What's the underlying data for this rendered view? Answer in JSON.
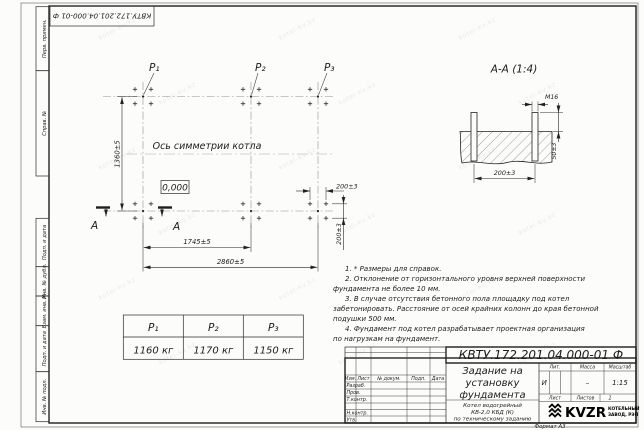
{
  "watermark": {
    "text": "kotel-kv.kz"
  },
  "stamp_top": {
    "doc_number": "КВТУ.172.201.04.000-01 Ф"
  },
  "margin_labels": {
    "perv": "Перв. примен.",
    "sprav": "Справ. №",
    "podp1": "Подп. и дата",
    "inv_dubl": "Инв. № дубл.",
    "vzam": "Взам. инв. №",
    "podp2": "Подп. и дата",
    "inv_podl": "Инв. № подл."
  },
  "plan": {
    "p1": "P₁",
    "p2": "P₂",
    "p3": "P₃",
    "axis_label": "Ось симметрии котла",
    "level": "0,000",
    "dim_v": "1360±5",
    "dim_1745": "1745±5",
    "dim_2860": "2860±5",
    "dim_200h": "200±3",
    "dim_200v": "200±3",
    "section_letter_left": "А",
    "section_letter_right": "А"
  },
  "section": {
    "title": "А-А (1:4)",
    "thread": "М16",
    "dim_50": "50±3",
    "dim_200": "200±3"
  },
  "notes": {
    "lines": [
      "1. * Размеры для справок.",
      "2. Отклонение от горизонтального уровня верхней поверхности",
      "фундамента не более 10 мм.",
      "3. В случае отсутствия бетонного пола площадку под котел",
      "забетонировать. Расстояние от осей крайних колонн до края бетонной",
      "подушки 500 мм.",
      "4. Фундамент под котел разрабатывает проектная организация",
      "по нагрузкам на фундамент."
    ]
  },
  "load_table": {
    "headers": [
      "P₁",
      "P₂",
      "P₃"
    ],
    "values": [
      "1160 кг",
      "1170 кг",
      "1150 кг"
    ]
  },
  "title_block": {
    "doc_number": "КВТУ.172.201.04.000-01 Ф",
    "title_lines": [
      "Задание на",
      "установку",
      "фундамента"
    ],
    "subtitle_lines": [
      "Котел водогрейный",
      "КВ-2,0 КБД (К)",
      "по техническому заданию"
    ],
    "cols": {
      "izm": "Изм.",
      "list": "Лист",
      "doc": "№ докум.",
      "podp": "Подп.",
      "data": "Дата"
    },
    "rows": {
      "razrab": "Разраб.",
      "prov": "Пров.",
      "tkontr": "Т.контр.",
      "nkontr": "Н.контр.",
      "utv": "Утв."
    },
    "lit_label": "Лит.",
    "massa_label": "Масса",
    "masshtab_label": "Масштаб",
    "lit_value": "И",
    "massa_value": "–",
    "masshtab_value": "1:15",
    "list_label": "Лист",
    "listov_label": "Листов",
    "listov_value": "1",
    "logo_text": "KVZR",
    "logo_sub1": "КОТЕЛЬНЫЙ",
    "logo_sub2": "ЗАВОД, РЭП",
    "format": "Формат А3"
  }
}
